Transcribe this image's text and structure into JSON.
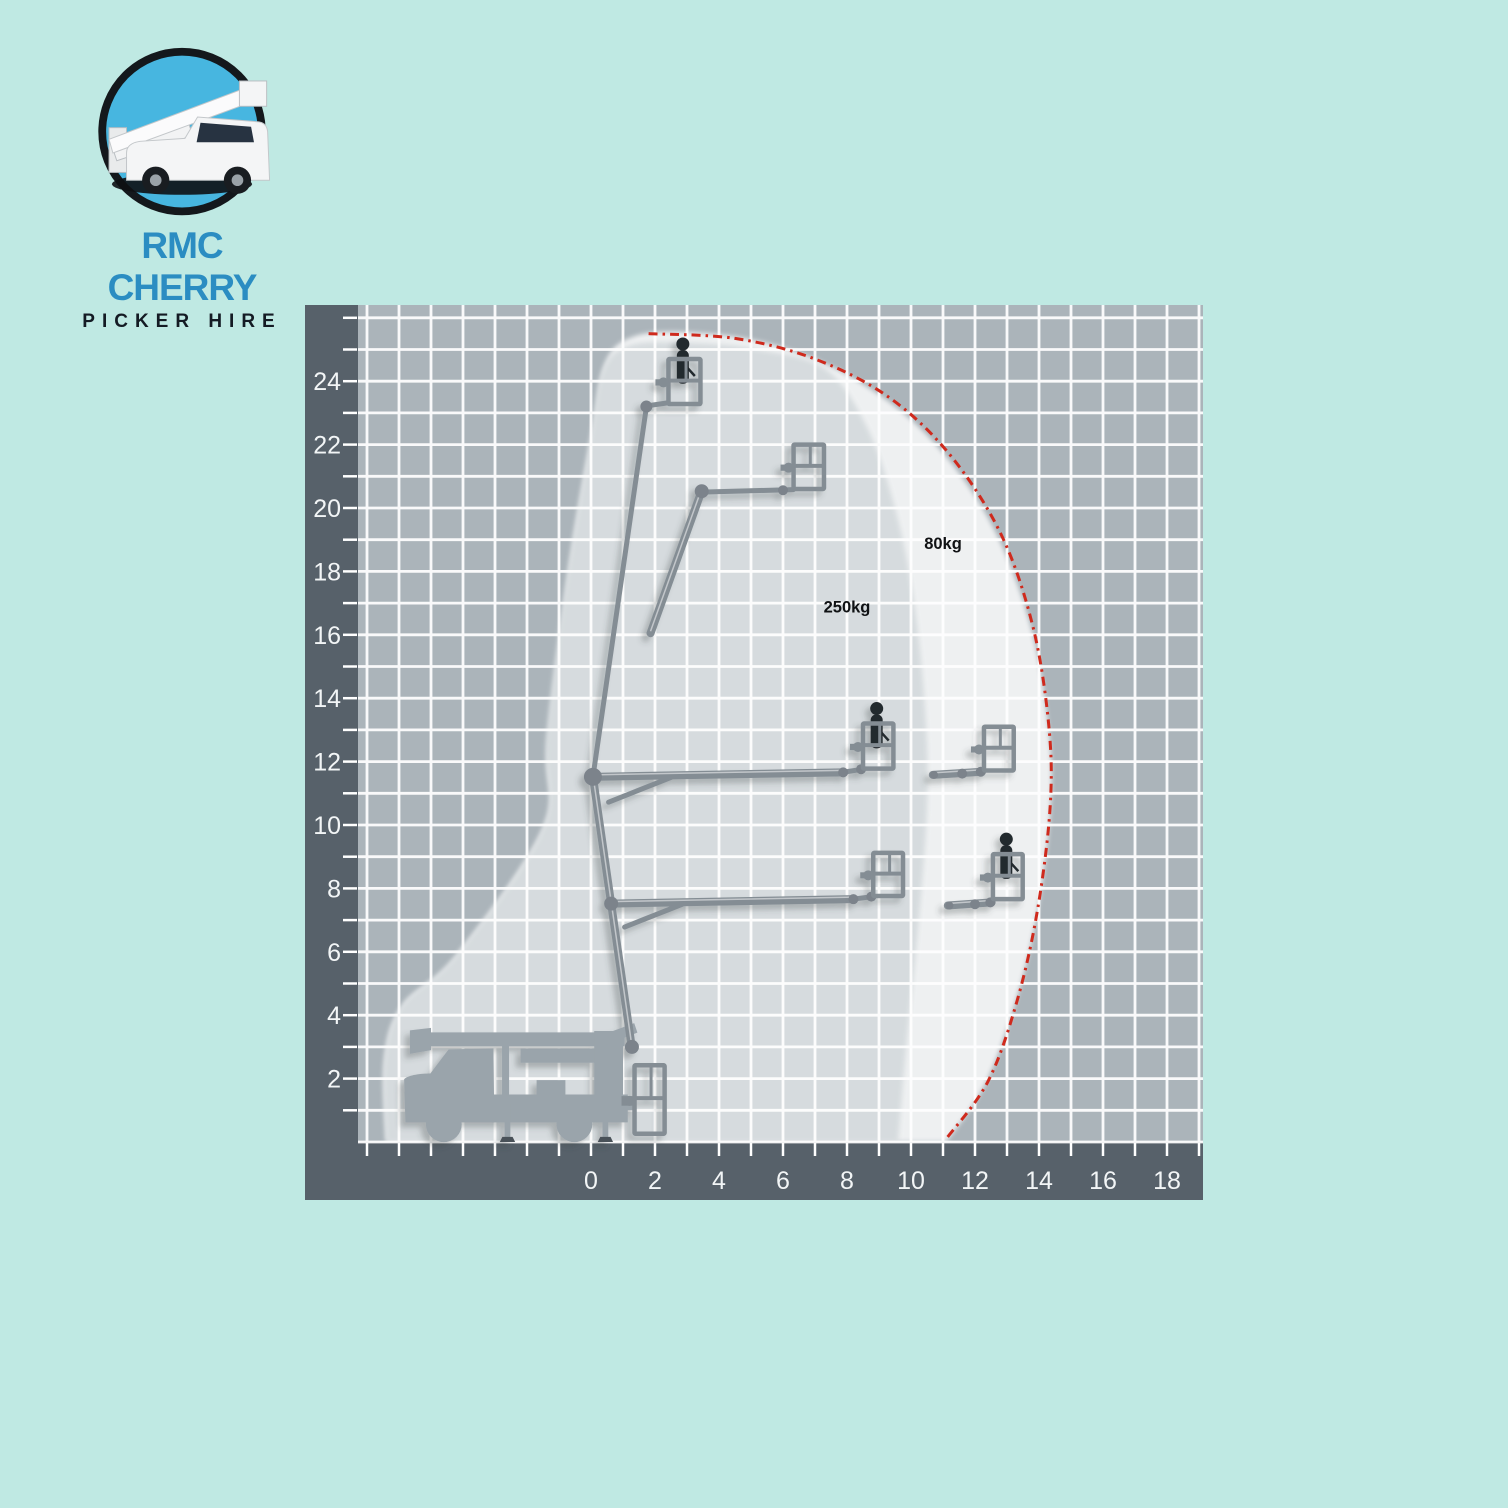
{
  "page": {
    "background": "#bfe9e3"
  },
  "logo": {
    "line1": "RMC CHERRY",
    "line2": "PICKER HIRE",
    "line1_color": "#2b8dc2",
    "line2_color": "#141b24",
    "circle_fill": "#47b6e0",
    "ring_color": "#14181c"
  },
  "chart_data": {
    "type": "area",
    "title": "Cherry picker working envelope / reach diagram",
    "xlabel": "Outreach (m)",
    "ylabel": "Working height (m)",
    "x_ticks": [
      0,
      2,
      4,
      6,
      8,
      10,
      12,
      14,
      16,
      18
    ],
    "y_ticks": [
      2,
      4,
      6,
      8,
      10,
      12,
      14,
      16,
      18,
      20,
      22,
      24
    ],
    "x_minor_step": 1,
    "y_minor_step": 1,
    "x_range_units": [
      -7.3,
      19.2
    ],
    "y_range_units": [
      0,
      26.4
    ],
    "grid": true,
    "legend_position": "none",
    "colors": {
      "axis_band": "#57616a",
      "grid_cell": "#abb4ba",
      "grid_line": "#ffffff",
      "envelope_250": "#d6dbde",
      "envelope_80": "rgba(255,255,255,0.80)",
      "machine": "#848d94",
      "joint": "#7b838b",
      "truck": "#9aa4ab",
      "person": "#24292e",
      "limit_line": "#cf2a1d",
      "load_label": "#101214",
      "tick_label": "#f2f5f6",
      "pad": "#4a5158"
    },
    "envelopes": [
      {
        "name": "envelope-80kg",
        "max_outreach_m": 14.4,
        "max_height_m": 25.6,
        "ground_outreach_m": 11.1,
        "points": [
          [
            -6.4,
            0
          ],
          [
            -6.45,
            2.6
          ],
          [
            -5.9,
            4.3
          ],
          [
            -4.2,
            5.9
          ],
          [
            -1.5,
            9.9
          ],
          [
            -1.35,
            12.5
          ],
          [
            -0.7,
            18
          ],
          [
            0.05,
            22.5
          ],
          [
            0.45,
            24.6
          ],
          [
            1.3,
            25.4
          ],
          [
            3.0,
            25.55
          ],
          [
            5.5,
            25.2
          ],
          [
            8.0,
            24.2
          ],
          [
            10.4,
            22.4
          ],
          [
            12.4,
            19.7
          ],
          [
            13.7,
            16.4
          ],
          [
            14.3,
            13.0
          ],
          [
            14.35,
            10.4
          ],
          [
            13.9,
            7.0
          ],
          [
            13.2,
            4.2
          ],
          [
            12.3,
            1.8
          ],
          [
            11.1,
            0
          ]
        ]
      },
      {
        "name": "envelope-250kg",
        "max_outreach_m": 10.5,
        "max_height_m": 25.2,
        "ground_outreach_m": 9.6,
        "points": [
          [
            -6.4,
            0
          ],
          [
            -6.45,
            2.6
          ],
          [
            -5.9,
            4.3
          ],
          [
            -4.2,
            5.9
          ],
          [
            -1.5,
            9.9
          ],
          [
            -1.4,
            12.8
          ],
          [
            -0.8,
            17.5
          ],
          [
            0.0,
            22.3
          ],
          [
            0.4,
            24.4
          ],
          [
            1.3,
            25.15
          ],
          [
            3.2,
            25.2
          ],
          [
            5.2,
            25.0
          ],
          [
            7.3,
            24.4
          ],
          [
            8.6,
            22.6
          ],
          [
            9.5,
            20.0
          ],
          [
            10.1,
            17.0
          ],
          [
            10.45,
            13.5
          ],
          [
            10.5,
            10.5
          ],
          [
            10.2,
            6.5
          ],
          [
            9.85,
            3.0
          ],
          [
            9.6,
            0
          ]
        ]
      }
    ],
    "boundary_80kg": [
      [
        1.8,
        25.5
      ],
      [
        4.5,
        25.35
      ],
      [
        7.0,
        24.7
      ],
      [
        9.3,
        23.5
      ],
      [
        11.2,
        21.7
      ],
      [
        12.8,
        19.2
      ],
      [
        13.8,
        16.3
      ],
      [
        14.3,
        13.2
      ],
      [
        14.35,
        10.6
      ],
      [
        13.95,
        7.3
      ],
      [
        13.3,
        4.4
      ],
      [
        12.4,
        1.9
      ],
      [
        11.1,
        0.1
      ]
    ],
    "labels": [
      {
        "text": "80kg",
        "x": 11.0,
        "y": 18.7
      },
      {
        "text": "250kg",
        "x": 8.0,
        "y": 16.7
      }
    ],
    "positions": [
      {
        "name": "stowed-on-truck",
        "kind": "truck",
        "basket": {
          "x": 1.36,
          "y": 0.26,
          "w": 0.94,
          "h": 2.16
        },
        "person": false
      },
      {
        "name": "full-height",
        "kind": "boom",
        "segments": [
          [
            [
              1.28,
              2.95
            ],
            [
              0.06,
              11.52
            ]
          ],
          [
            [
              0.06,
              11.52
            ],
            [
              1.73,
              23.18
            ]
          ],
          [
            [
              1.73,
              23.22
            ],
            [
              2.42,
              23.32
            ]
          ]
        ],
        "joints": [
          [
            0.06,
            11.52,
            8
          ],
          [
            1.73,
            23.2,
            6
          ],
          [
            1.28,
            3.0,
            7
          ]
        ],
        "basket": {
          "x": 2.42,
          "y": 23.28,
          "w": 1.0,
          "h": 1.42
        },
        "person": true
      },
      {
        "name": "articulated-up",
        "kind": "boom",
        "segments": [
          [
            [
              1.86,
              16.05
            ],
            [
              3.46,
              20.55
            ]
          ],
          [
            [
              3.46,
              20.5
            ],
            [
              6.32,
              20.58
            ]
          ]
        ],
        "joints": [
          [
            3.46,
            20.53,
            7
          ],
          [
            6.0,
            20.56,
            5
          ]
        ],
        "basket": {
          "x": 6.33,
          "y": 20.6,
          "w": 0.95,
          "h": 1.4
        },
        "person": false
      },
      {
        "name": "mid-reach-250kg",
        "kind": "boom",
        "segments": [
          [
            [
              0.06,
              11.52
            ],
            [
              7.85,
              11.66
            ]
          ],
          [
            [
              0.55,
              10.72
            ],
            [
              2.5,
              11.5
            ]
          ],
          [
            [
              7.85,
              11.66
            ],
            [
              8.5,
              11.76
            ]
          ]
        ],
        "joints": [
          [
            0.06,
            11.52,
            9
          ],
          [
            7.88,
            11.66,
            5
          ],
          [
            8.44,
            11.76,
            5
          ]
        ],
        "basket": {
          "x": 8.5,
          "y": 11.78,
          "w": 0.95,
          "h": 1.42
        },
        "person": true
      },
      {
        "name": "mid-reach-80kg",
        "kind": "boom",
        "segments": [
          [
            [
              10.68,
              11.58
            ],
            [
              12.22,
              11.68
            ]
          ]
        ],
        "joints": [
          [
            10.72,
            11.58,
            4
          ],
          [
            11.6,
            11.62,
            5
          ],
          [
            12.18,
            11.68,
            5
          ]
        ],
        "basket": {
          "x": 12.28,
          "y": 11.72,
          "w": 0.93,
          "h": 1.38
        },
        "person": false
      },
      {
        "name": "low-reach-250kg",
        "kind": "boom",
        "segments": [
          [
            [
              0.63,
              7.52
            ],
            [
              8.18,
              7.66
            ]
          ],
          [
            [
              1.05,
              6.78
            ],
            [
              2.85,
              7.5
            ]
          ],
          [
            [
              8.18,
              7.66
            ],
            [
              8.8,
              7.74
            ]
          ]
        ],
        "joints": [
          [
            0.63,
            7.52,
            7
          ],
          [
            8.2,
            7.66,
            5
          ],
          [
            8.76,
            7.74,
            5
          ]
        ],
        "basket": {
          "x": 8.82,
          "y": 7.76,
          "w": 0.93,
          "h": 1.36
        },
        "person": false
      },
      {
        "name": "low-reach-80kg",
        "kind": "boom",
        "segments": [
          [
            [
              11.15,
              7.46
            ],
            [
              12.52,
              7.56
            ]
          ]
        ],
        "joints": [
          [
            11.2,
            7.46,
            4
          ],
          [
            12.0,
            7.5,
            5
          ],
          [
            12.48,
            7.56,
            5
          ]
        ],
        "basket": {
          "x": 12.56,
          "y": 7.66,
          "w": 0.93,
          "h": 1.42
        },
        "person": true
      }
    ]
  }
}
